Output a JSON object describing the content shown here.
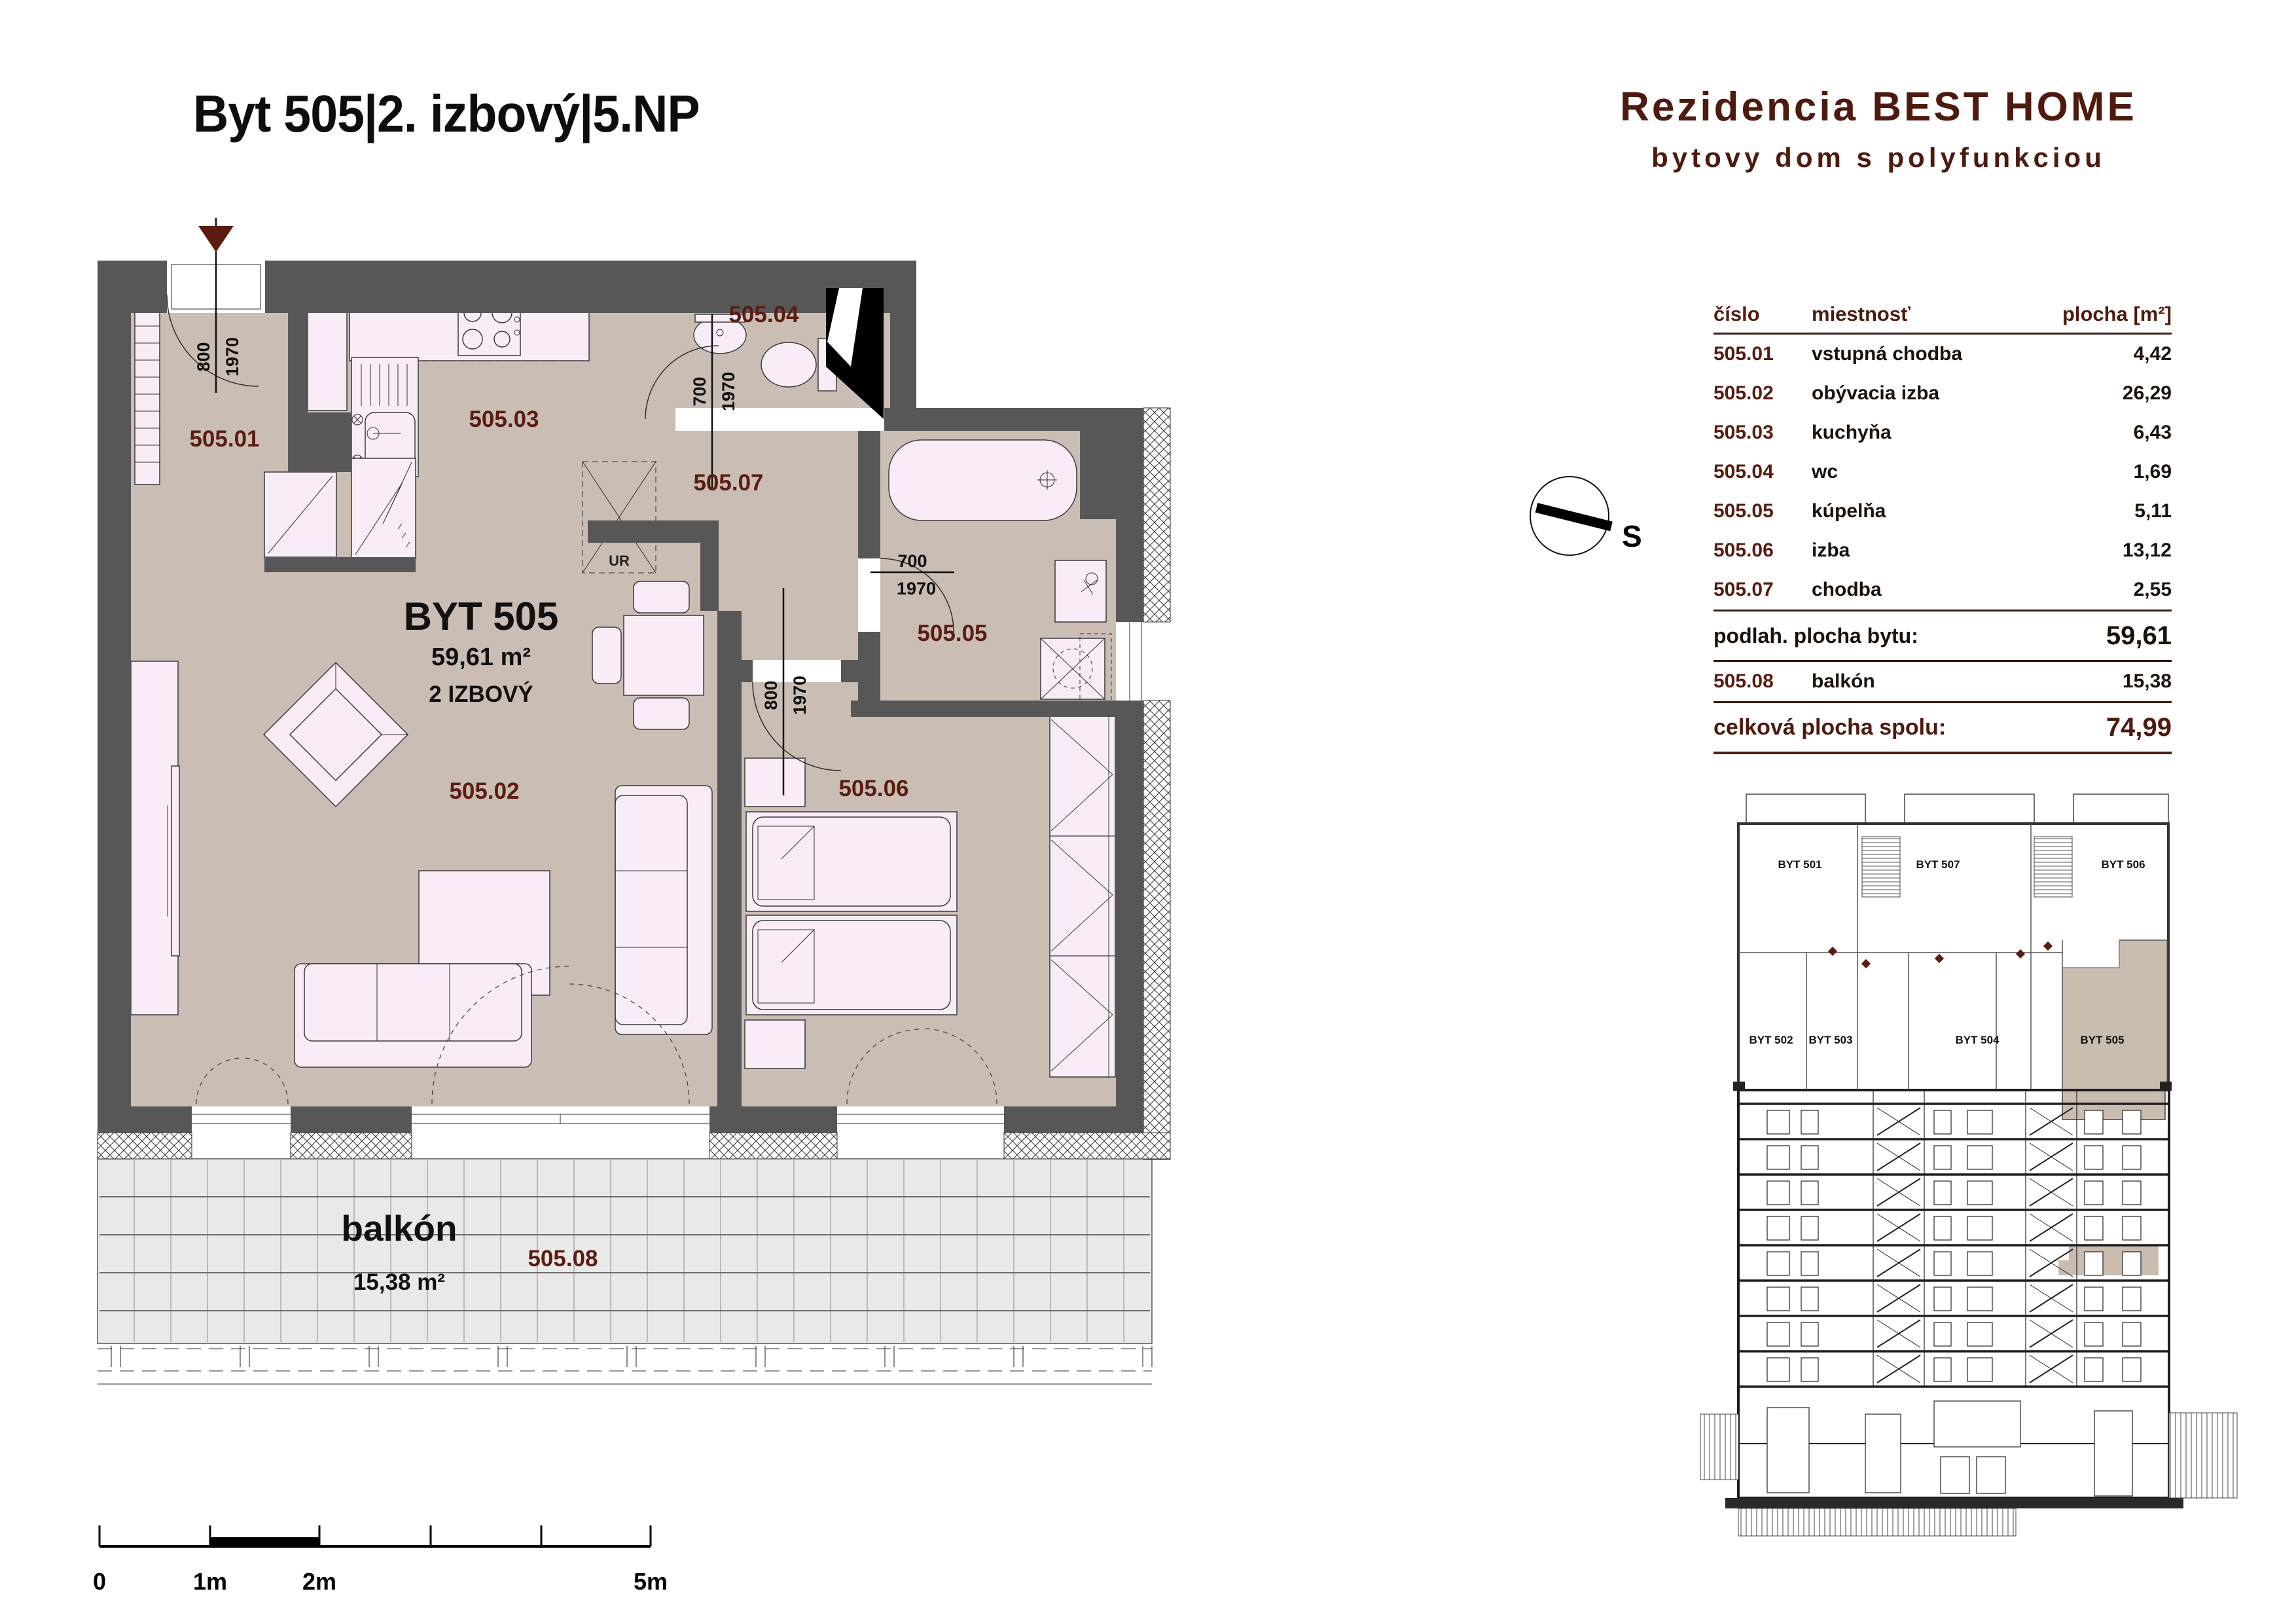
{
  "header": {
    "apartment_title": "Byt 505|2. izbový|5.NP",
    "project_title": "Rezidencia BEST HOME",
    "project_subtitle": "bytovy dom s polyfunkciou"
  },
  "plan": {
    "apartment_name": "BYT 505",
    "apartment_area": "59,61 m²",
    "apartment_type": "2 IZBOVÝ",
    "rooms": [
      {
        "id": "505.01"
      },
      {
        "id": "505.02"
      },
      {
        "id": "505.03"
      },
      {
        "id": "505.04"
      },
      {
        "id": "505.05"
      },
      {
        "id": "505.06"
      },
      {
        "id": "505.07"
      }
    ],
    "balcony": {
      "name": "balkón",
      "area": "15,38 m²",
      "id": "505.08"
    },
    "kitchen_unit_label": "UR",
    "door_dimensions": [
      {
        "width": "800",
        "height": "1970"
      },
      {
        "width": "700",
        "height": "1970"
      },
      {
        "width": "700",
        "height": "1970"
      },
      {
        "width": "800",
        "height": "1970"
      }
    ]
  },
  "rooms_table": {
    "headers": {
      "number": "číslo",
      "room": "miestnosť",
      "area": "plocha [m²]"
    },
    "rows": [
      [
        "505.01",
        "vstupná chodba",
        "4,42"
      ],
      [
        "505.02",
        "obývacia izba",
        "26,29"
      ],
      [
        "505.03",
        "kuchyňa",
        "6,43"
      ],
      [
        "505.04",
        "wc",
        "1,69"
      ],
      [
        "505.05",
        "kúpelňa",
        "5,11"
      ],
      [
        "505.06",
        "izba",
        "13,12"
      ],
      [
        "505.07",
        "chodba",
        "2,55"
      ]
    ],
    "subtotal": {
      "label": "podlah. plocha bytu:",
      "value": "59,61"
    },
    "balcony_row": {
      "number": "505.08",
      "room": "balkón",
      "value": "15,38"
    },
    "total": {
      "label": "celková plocha spolu:",
      "value": "74,99"
    }
  },
  "compass": {
    "south_label": "S"
  },
  "floor_overview": {
    "units": [
      {
        "name": "BYT 501"
      },
      {
        "name": "BYT 507"
      },
      {
        "name": "BYT 506"
      },
      {
        "name": "BYT 502"
      },
      {
        "name": "BYT 503"
      },
      {
        "name": "BYT 504"
      },
      {
        "name": "BYT 505"
      }
    ],
    "highlighted_unit": "BYT 505"
  },
  "scale_bar": {
    "labels": [
      "0",
      "1m",
      "2m",
      "5m"
    ]
  },
  "colors": {
    "wall_gray": "#575757",
    "floor_tan": "#cabdb3",
    "furniture_pink": "#f8edf6",
    "accent_maroon": "#5a1c10",
    "highlight_beige": "#cbbcb0",
    "balcony_gray": "#e9e9e9"
  }
}
